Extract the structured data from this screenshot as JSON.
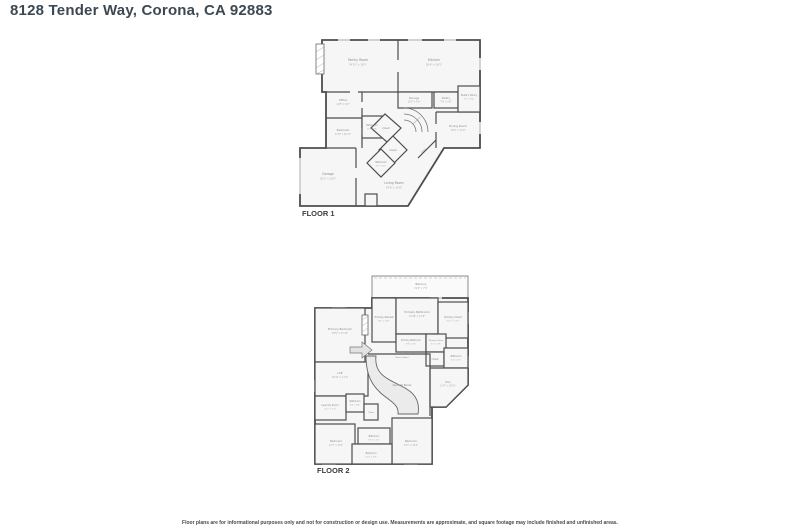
{
  "header": {
    "title": "8128 Tender Way, Corona, CA 92883"
  },
  "colors": {
    "wall": "#4d4d4d",
    "room_fill": "#f6f6f6",
    "title_text": "#3d4852",
    "label_text": "#8a8a8a"
  },
  "floors": [
    {
      "label": "FLOOR 1",
      "rooms": [
        {
          "name": "Family Room",
          "dims": "24'10\" x 16'5\""
        },
        {
          "name": "Kitchen",
          "dims": "26'4\" x 16'5\""
        },
        {
          "name": "Office",
          "dims": "11'8\" x 9'2\""
        },
        {
          "name": "Storage",
          "dims": "10'9\" x 5'6\""
        },
        {
          "name": "Pantry",
          "dims": "7'6\" x 5'6\""
        },
        {
          "name": "Butler's Pantry",
          "dims": "7'2\" x 8'4\""
        },
        {
          "name": "Dining Room",
          "dims": "14'6\" x 11'9\""
        },
        {
          "name": "Bedroom",
          "dims": "11'8\" x 10'11\""
        },
        {
          "name": "Bathroom",
          "dims": "7'5\" x 6'8\""
        },
        {
          "name": "Closet"
        },
        {
          "name": "Closet"
        },
        {
          "name": "Bathroom",
          "dims": "6'9\" x 6'2\""
        },
        {
          "name": "Garage",
          "dims": "18'2\" x 19'0\""
        },
        {
          "name": "Living Room",
          "dims": "24'6\" x 15'8\""
        },
        {
          "name": "Stairs (up)"
        },
        {
          "name": "Entry"
        }
      ]
    },
    {
      "label": "FLOOR 2",
      "rooms": [
        {
          "name": "Balcony",
          "dims": "31'0\" x 7'4\""
        },
        {
          "name": "Primary Bathroom",
          "dims": "13'10\" x 11'6\""
        },
        {
          "name": "Primary Retreat",
          "dims": "8'0\" x 13'6\""
        },
        {
          "name": "Primary Closet",
          "dims": "9'11\" x 11'5\""
        },
        {
          "name": "Primary Bedroom",
          "dims": "18'5\" x 17'10\""
        },
        {
          "name": "Primary Bathroom",
          "dims": "9'8\" x 5'4\""
        },
        {
          "name": "Primary Closet",
          "dims": "6'2\" x 5'8\""
        },
        {
          "name": "Closet"
        },
        {
          "name": "Bathroom",
          "dims": "7'4\" x 6'0\""
        },
        {
          "name": "Den",
          "dims": "12'4\" x 10'10\""
        },
        {
          "name": "Loft",
          "dims": "16'11\" x 11'2\""
        },
        {
          "name": "Open To Below"
        },
        {
          "name": "Stairs (down)"
        },
        {
          "name": "Laundry Room",
          "dims": "10'2\" x 7'3\""
        },
        {
          "name": "Bathroom",
          "dims": "6'8\" x 6'4\""
        },
        {
          "name": "Closet"
        },
        {
          "name": "Bedroom",
          "dims": "13'7\" x 12'6\""
        },
        {
          "name": "Bathroom",
          "dims": "9'10\" x 5'2\""
        },
        {
          "name": "Bedroom",
          "dims": "13'1\" x 14'2\""
        },
        {
          "name": "Bedroom",
          "dims": "12'3\" x 9'8\""
        }
      ]
    }
  ],
  "footer": {
    "disclaimer": "Floor plans are for informational purposes only and not for construction or design use. Measurements are approximate, and square footage may include finished and unfinished areas."
  }
}
